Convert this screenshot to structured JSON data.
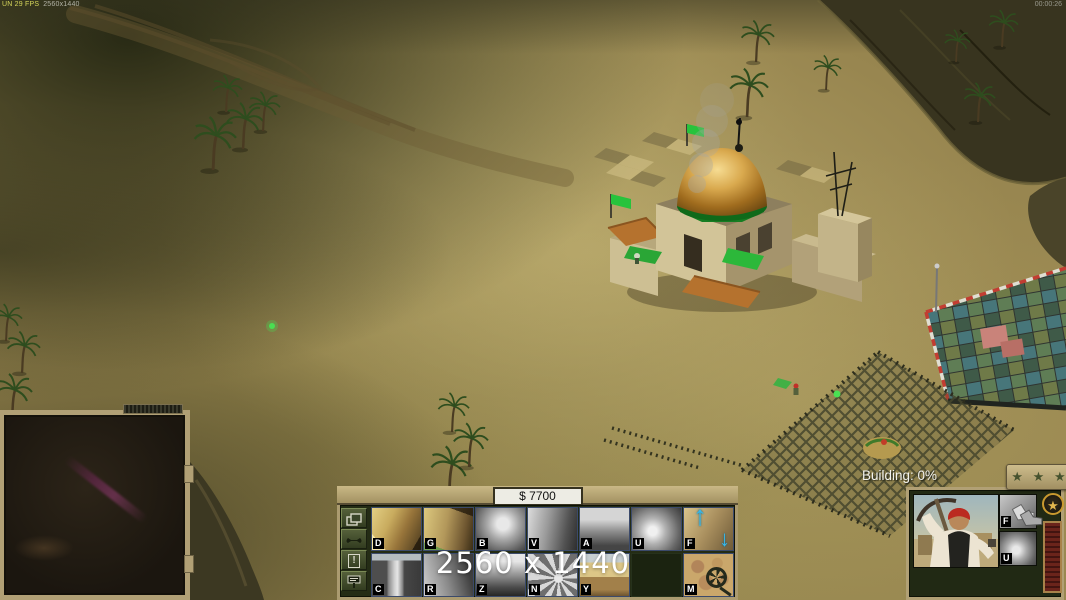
{
  "hud": {
    "debug_left": "UN 29 FPS",
    "debug_right": "2560x1440",
    "timer": "00:00:26",
    "watermark": "2560 x 1440",
    "money": "$ 7700",
    "status_text": "Building: 0%",
    "rank_stars": "★ ★ ★"
  },
  "icons": {
    "star": "★",
    "up_arrow": "↑",
    "down_arrow": "↓",
    "exclamation": "!",
    "side_button_icons": [
      "windows-icon",
      "wrench-icon",
      "exclamation-icon",
      "sell-sign-icon"
    ]
  },
  "build_grid": {
    "cells": [
      {
        "key": "D"
      },
      {
        "key": "G"
      },
      {
        "key": "B"
      },
      {
        "key": "V"
      },
      {
        "key": "A"
      },
      {
        "key": "U"
      },
      {
        "key": "F"
      },
      {
        "key": "C"
      },
      {
        "key": "R"
      },
      {
        "key": "Z"
      },
      {
        "key": "N"
      },
      {
        "key": "Y"
      },
      {
        "key": ""
      },
      {
        "key": "M"
      }
    ]
  },
  "unit_panel": {
    "ability1_key": "F",
    "ability2_key": "U"
  },
  "colors": {
    "ui_frame_tan": "#b1a075",
    "panel_olive": "#242c15",
    "hotkey_arrow_blue": "#38b8ea",
    "flag_green": "#27c33c",
    "dome_gold": "#d9a94e",
    "exp_bar_red": "#6b241b"
  }
}
